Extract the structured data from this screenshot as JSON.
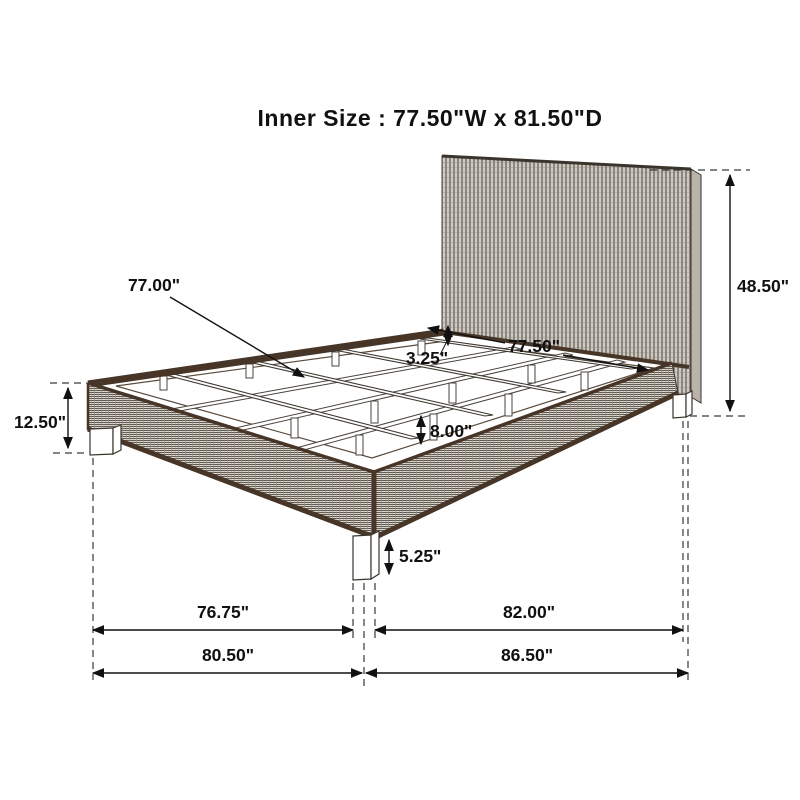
{
  "title": "Inner Size :  77.50\"W x 81.50\"D",
  "dimensions": {
    "slat_length": "77.00\"",
    "slat_thickness": "3.25\"",
    "inner_width": "77.50\"",
    "headboard_height": "48.50\"",
    "siderail_height": "12.50\"",
    "under_slat_height": "8.00\"",
    "leg_height": "5.25\"",
    "inner_span_width": "76.75\"",
    "inner_span_depth": "82.00\"",
    "overall_width": "80.50\"",
    "overall_depth": "86.50\""
  },
  "colors": {
    "frame_edge": "#473527",
    "annotation_line": "#111111",
    "weave_gray": "#8a847a"
  }
}
